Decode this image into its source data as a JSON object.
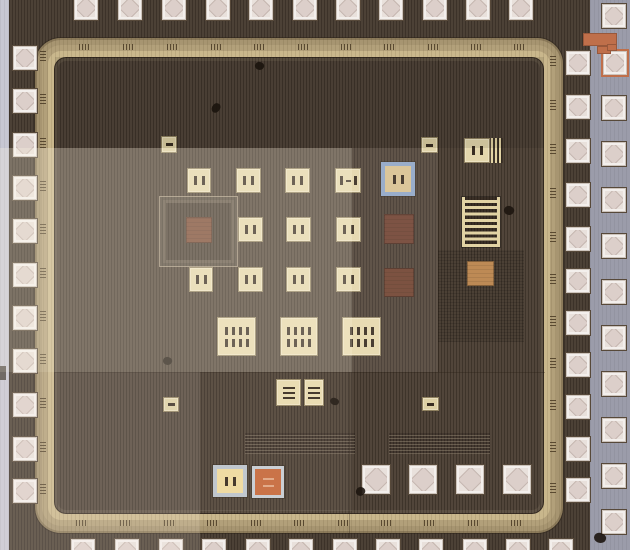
{
  "meta": {
    "kind": "ic-die-micrograph",
    "width": 630,
    "height": 550
  },
  "palette": {
    "die_dark": "#4c4136",
    "die_inner": "#51453a",
    "seal_ring_gold": "#c9b78c",
    "pad_white": "#f3efec",
    "pad_diamond_pink": "#dccfca",
    "probe_cream": "#e4d7ad",
    "orange_square": "#c66a3d",
    "copper_square": "#bd8a55",
    "maroon_square": "#714434",
    "blue_border": "#8fa7c7",
    "gray_border": "#bcc4cd",
    "scribe_gray": "#9b9caa",
    "edge_strip_gray": "#c7c7d3",
    "connector_orange": "#bf6f4a"
  },
  "regions": [
    {
      "name": "scribe-street-right",
      "x": 590,
      "y": 0,
      "w": 40,
      "h": 550,
      "kind": "gray",
      "color": "#9b9caa"
    },
    {
      "name": "die-edge-strip-left",
      "x": 0,
      "y": 0,
      "w": 9,
      "h": 550,
      "kind": "gray",
      "color": "#c7c7d3"
    },
    {
      "name": "edge-strip-notch",
      "x": 0,
      "y": 366,
      "w": 6,
      "h": 14,
      "kind": "solid",
      "color": "#55504c"
    },
    {
      "name": "seal-ring",
      "x": 35,
      "y": 38,
      "w": 528,
      "h": 495,
      "kind": "ring"
    },
    {
      "name": "die-core-fill",
      "x": 54,
      "y": 57,
      "w": 490,
      "h": 457,
      "kind": "inner"
    }
  ],
  "fill_blocks": [
    {
      "name": "framed-fill-block",
      "x": 159,
      "y": 196,
      "w": 79,
      "h": 71,
      "kind": "frame"
    },
    {
      "name": "stripe-fill-block-1",
      "x": 245,
      "y": 433,
      "w": 110,
      "h": 21,
      "kind": "stripes"
    },
    {
      "name": "stripe-fill-block-2",
      "x": 389,
      "y": 433,
      "w": 101,
      "h": 21,
      "kind": "stripes"
    },
    {
      "name": "stripe-fill-block-3",
      "x": 438,
      "y": 250,
      "w": 86,
      "h": 92,
      "kind": "stripes-faint"
    }
  ],
  "seams": [
    {
      "name": "stitch-seam-v1",
      "x": 438,
      "y": 60,
      "w": 1,
      "h": 312
    },
    {
      "name": "stitch-seam-v2",
      "x": 243,
      "y": 355,
      "w": 1,
      "h": 156
    },
    {
      "name": "stitch-seam-v3",
      "x": 349,
      "y": 372,
      "w": 1,
      "h": 178
    },
    {
      "name": "stitch-seam-h1",
      "x": 55,
      "y": 372,
      "w": 490,
      "h": 1
    }
  ],
  "bond_pads": {
    "size": 24,
    "top_row": {
      "y": -5,
      "x": [
        73,
        117,
        161,
        205,
        248,
        292,
        335,
        378,
        422,
        465,
        508
      ]
    },
    "bottom_row": {
      "y": 538,
      "x": [
        70,
        114,
        158,
        201,
        245,
        288,
        332,
        375,
        418,
        462,
        505,
        548
      ]
    },
    "left_col": {
      "x": 12,
      "y": [
        45,
        88,
        132,
        175,
        218,
        262,
        305,
        348,
        392,
        436,
        478
      ]
    },
    "right_inner": {
      "x": 565,
      "y": [
        50,
        94,
        138,
        182,
        226,
        268,
        310,
        352,
        394,
        436,
        477
      ]
    },
    "right_outer": {
      "x": 601,
      "y": [
        3,
        49,
        95,
        141,
        187,
        233,
        279,
        325,
        371,
        417,
        463,
        509
      ],
      "orange_border_index": 1
    }
  },
  "inner_probe_pads": [
    {
      "name": "inner-white-pad-1",
      "x": 361,
      "y": 464,
      "w": 28,
      "h": 29
    },
    {
      "name": "inner-white-pad-2",
      "x": 408,
      "y": 464,
      "w": 28,
      "h": 29
    },
    {
      "name": "inner-white-pad-3",
      "x": 455,
      "y": 464,
      "w": 28,
      "h": 29
    },
    {
      "name": "inner-white-pad-4",
      "x": 502,
      "y": 464,
      "w": 28,
      "h": 29
    }
  ],
  "features": [
    {
      "name": "probe-square-a1",
      "k": "sq",
      "x": 187,
      "y": 168,
      "w": 24,
      "h": 25,
      "fc": "#e4d7ad",
      "m": "2v"
    },
    {
      "name": "probe-square-a2",
      "k": "sq",
      "x": 236,
      "y": 168,
      "w": 25,
      "h": 25,
      "fc": "#e4d7ad",
      "m": "2v"
    },
    {
      "name": "probe-square-a3",
      "k": "sq",
      "x": 285,
      "y": 168,
      "w": 25,
      "h": 25,
      "fc": "#e4d7ad",
      "m": "2v"
    },
    {
      "name": "probe-square-a4",
      "k": "sq",
      "x": 335,
      "y": 168,
      "w": 26,
      "h": 25,
      "fc": "#e4d7ad",
      "m": "2v_h"
    },
    {
      "name": "probe-square-b1",
      "k": "sq",
      "x": 238,
      "y": 217,
      "w": 25,
      "h": 25,
      "fc": "#e4d7ad",
      "m": "2v"
    },
    {
      "name": "probe-square-b2",
      "k": "sq",
      "x": 286,
      "y": 217,
      "w": 25,
      "h": 25,
      "fc": "#e4d7ad",
      "m": "2v"
    },
    {
      "name": "probe-square-b3",
      "k": "sq",
      "x": 336,
      "y": 217,
      "w": 25,
      "h": 25,
      "fc": "#e4d7ad",
      "m": "2v"
    },
    {
      "name": "probe-square-c1",
      "k": "sq",
      "x": 189,
      "y": 267,
      "w": 24,
      "h": 25,
      "fc": "#e4d7ad",
      "m": "2v"
    },
    {
      "name": "probe-square-c2",
      "k": "sq",
      "x": 238,
      "y": 267,
      "w": 25,
      "h": 25,
      "fc": "#e4d7ad",
      "m": "2v"
    },
    {
      "name": "probe-square-c3",
      "k": "sq",
      "x": 286,
      "y": 267,
      "w": 25,
      "h": 25,
      "fc": "#e4d7ad",
      "m": "2v"
    },
    {
      "name": "probe-square-c4",
      "k": "sq",
      "x": 336,
      "y": 267,
      "w": 25,
      "h": 25,
      "fc": "#e4d7ad",
      "m": "2v"
    },
    {
      "name": "probe-square-topright",
      "k": "sq",
      "x": 464,
      "y": 138,
      "w": 26,
      "h": 25,
      "fc": "#e4d7ad",
      "m": "2v"
    },
    {
      "name": "mini-square-1",
      "k": "sq",
      "x": 161,
      "y": 136,
      "w": 16,
      "h": 17,
      "fc": "#ddd0a4",
      "m": "1h"
    },
    {
      "name": "mini-square-2",
      "k": "sq",
      "x": 421,
      "y": 137,
      "w": 17,
      "h": 16,
      "fc": "#ddd0a4",
      "m": "1h"
    },
    {
      "name": "mini-square-3",
      "k": "sq",
      "x": 163,
      "y": 397,
      "w": 16,
      "h": 15,
      "fc": "#ddd0a4",
      "m": "1h"
    },
    {
      "name": "mini-square-4",
      "k": "sq",
      "x": 422,
      "y": 397,
      "w": 17,
      "h": 14,
      "fc": "#ddd0a4",
      "m": "1h"
    },
    {
      "name": "pair-square-left",
      "k": "sq",
      "x": 276,
      "y": 379,
      "w": 25,
      "h": 27,
      "fc": "#e8dbb0",
      "m": "3h"
    },
    {
      "name": "pair-square-right",
      "k": "sq",
      "x": 304,
      "y": 379,
      "w": 20,
      "h": 27,
      "fc": "#e8dbb0",
      "m": "3h"
    },
    {
      "name": "big-probe-square-1",
      "k": "sq",
      "x": 217,
      "y": 317,
      "w": 39,
      "h": 39,
      "fc": "#e6d9ae",
      "m": "8v"
    },
    {
      "name": "big-probe-square-2",
      "k": "sq",
      "x": 280,
      "y": 317,
      "w": 38,
      "h": 39,
      "fc": "#e6d9ae",
      "m": "8v"
    },
    {
      "name": "big-probe-square-3",
      "k": "sq",
      "x": 342,
      "y": 317,
      "w": 39,
      "h": 39,
      "fc": "#e6d9ae",
      "m": "8v"
    },
    {
      "name": "blue-bordered-square",
      "k": "sq",
      "x": 381,
      "y": 162,
      "w": 34,
      "h": 34,
      "fc": "#d8c293",
      "bc": "#8fa7c7",
      "bw": 4,
      "m": "2v"
    },
    {
      "name": "gray-bordered-cream-square",
      "k": "sq",
      "x": 213,
      "y": 465,
      "w": 34,
      "h": 32,
      "fc": "#eeda9f",
      "bc": "#bcc4cd",
      "bw": 4,
      "m": "2v"
    },
    {
      "name": "orange-test-square",
      "k": "sq",
      "x": 252,
      "y": 466,
      "w": 32,
      "h": 32,
      "fc": "#c66a3d",
      "bc": "#c8cdd3",
      "bw": 3,
      "m": "2h_light"
    },
    {
      "name": "brown-square-left",
      "k": "solid",
      "x": 186,
      "y": 217,
      "w": 26,
      "h": 26,
      "fc": "#7a4a36"
    },
    {
      "name": "maroon-square-1",
      "k": "solid",
      "x": 384,
      "y": 214,
      "w": 30,
      "h": 30,
      "fc": "#714434"
    },
    {
      "name": "maroon-square-2",
      "k": "solid",
      "x": 384,
      "y": 268,
      "w": 30,
      "h": 29,
      "fc": "#6f4331"
    },
    {
      "name": "copper-square",
      "k": "solid",
      "x": 467,
      "y": 261,
      "w": 27,
      "h": 25,
      "fc": "#bd8a55"
    },
    {
      "name": "meander-resistor",
      "k": "meander",
      "x": 462,
      "y": 197,
      "w": 38,
      "h": 50
    },
    {
      "name": "vertical-bars-block",
      "k": "vbars",
      "x": 491,
      "y": 138,
      "w": 12,
      "h": 25
    }
  ],
  "connector": [
    {
      "name": "orange-connector-bar",
      "x": 583,
      "y": 33,
      "w": 34,
      "h": 13,
      "color": "#bf6f4a"
    },
    {
      "name": "orange-connector-stub",
      "x": 597,
      "y": 46,
      "w": 14,
      "h": 8,
      "color": "#bf6f4a"
    },
    {
      "name": "orange-pad-tab",
      "x": 607,
      "y": 44,
      "w": 10,
      "h": 7,
      "color": "#bf6f4a"
    }
  ],
  "specks": [
    {
      "name": "dust-speck-1",
      "x": 255,
      "y": 62,
      "w": 9,
      "h": 8
    },
    {
      "name": "dust-speck-2",
      "x": 212,
      "y": 103,
      "w": 8,
      "h": 10
    },
    {
      "name": "dust-speck-3",
      "x": 163,
      "y": 357,
      "w": 9,
      "h": 8
    },
    {
      "name": "dust-speck-4",
      "x": 330,
      "y": 398,
      "w": 9,
      "h": 7
    },
    {
      "name": "dust-speck-5",
      "x": 504,
      "y": 206,
      "w": 10,
      "h": 9
    },
    {
      "name": "dust-speck-6",
      "x": 356,
      "y": 487,
      "w": 9,
      "h": 9
    },
    {
      "name": "dust-speck-7",
      "x": 594,
      "y": 533,
      "w": 12,
      "h": 10
    }
  ],
  "lighting_overlays": [
    {
      "name": "exposure-tile-bright-left",
      "x": 0,
      "y": 148,
      "w": 352,
      "h": 224,
      "color": "rgba(255,246,230,0.27)"
    },
    {
      "name": "exposure-tile-mid",
      "x": 352,
      "y": 148,
      "w": 86,
      "h": 224,
      "color": "rgba(255,246,230,0.09)"
    },
    {
      "name": "exposure-tile-bottom-left",
      "x": 0,
      "y": 372,
      "w": 200,
      "h": 178,
      "color": "rgba(255,246,230,0.17)"
    },
    {
      "name": "exposure-tile-bottom-center",
      "x": 200,
      "y": 372,
      "w": 152,
      "h": 139,
      "color": "rgba(255,246,230,0.07)"
    },
    {
      "name": "exposure-tile-dark-top",
      "x": 55,
      "y": 57,
      "w": 489,
      "h": 91,
      "color": "rgba(10,6,2,0.10)"
    }
  ]
}
